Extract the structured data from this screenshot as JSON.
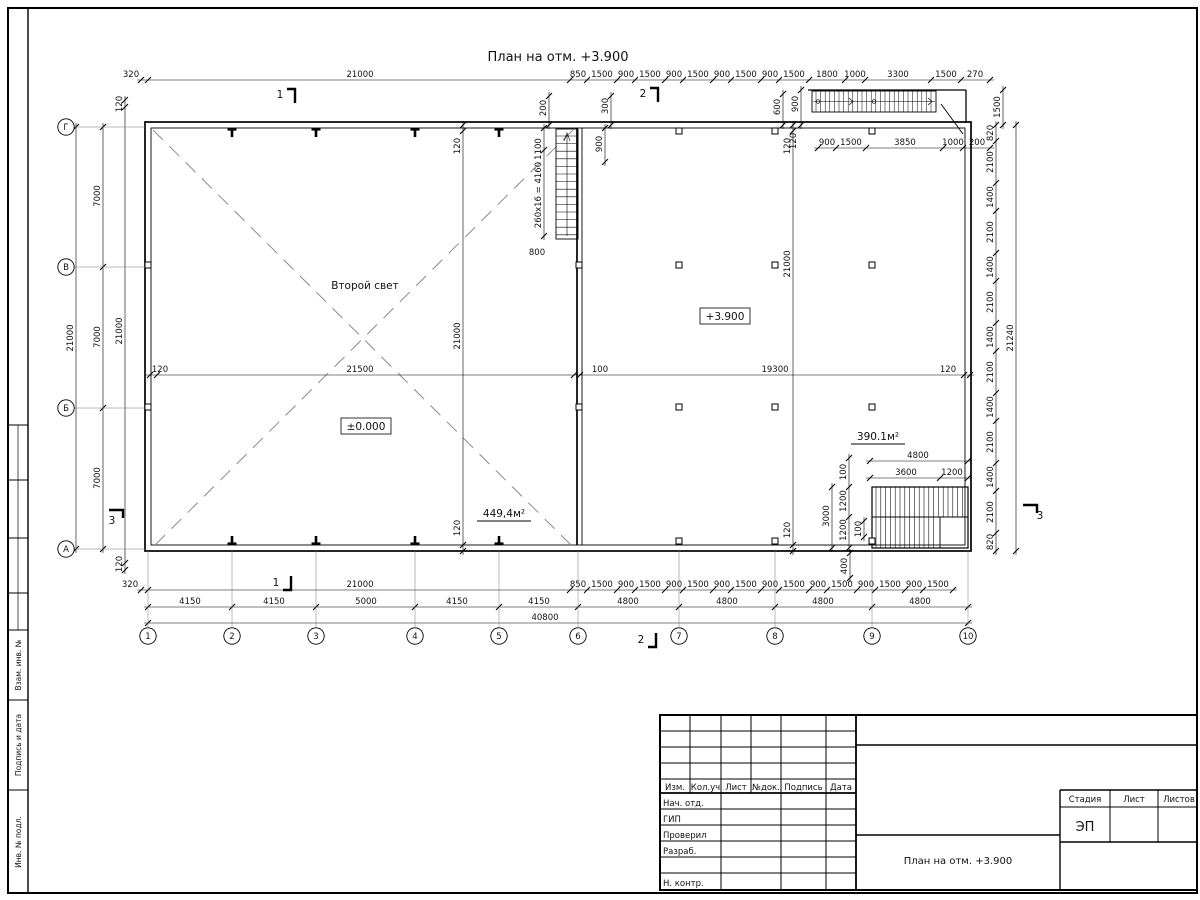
{
  "page": {
    "title": "План на отм. +3.900"
  },
  "colors": {
    "line": "#000000",
    "dash": "#8a8a8a",
    "bg": "#ffffff"
  },
  "rooms": [
    {
      "t": "Второй свет",
      "x": 365,
      "y": 289,
      "style": "plain"
    },
    {
      "t": "±0.000",
      "x": 366,
      "y": 430,
      "style": "boxed"
    },
    {
      "t": "+3.900",
      "x": 725,
      "y": 320,
      "style": "boxed"
    },
    {
      "t": "449,4м²",
      "x": 504,
      "y": 517,
      "style": "area"
    },
    {
      "t": "390.1м²",
      "x": 878,
      "y": 440,
      "style": "area"
    }
  ],
  "axes": {
    "letters": [
      {
        "t": "Г",
        "y": 127
      },
      {
        "t": "В",
        "y": 267
      },
      {
        "t": "Б",
        "y": 408
      },
      {
        "t": "А",
        "y": 549
      }
    ],
    "numbers": [
      {
        "t": "1",
        "x": 148
      },
      {
        "t": "2",
        "x": 232
      },
      {
        "t": "3",
        "x": 316
      },
      {
        "t": "4",
        "x": 415
      },
      {
        "t": "5",
        "x": 499
      },
      {
        "t": "6",
        "x": 578
      },
      {
        "t": "7",
        "x": 679
      },
      {
        "t": "8",
        "x": 775
      },
      {
        "t": "9",
        "x": 872
      },
      {
        "t": "10",
        "x": 968
      }
    ]
  },
  "markers": [
    {
      "t": "1",
      "x": 280,
      "y": 98,
      "d": "t"
    },
    {
      "t": "1",
      "x": 276,
      "y": 586,
      "d": "b"
    },
    {
      "t": "2",
      "x": 643,
      "y": 97,
      "d": "t"
    },
    {
      "t": "2",
      "x": 641,
      "y": 643,
      "d": "b"
    },
    {
      "t": "3",
      "x": 112,
      "y": 524,
      "d": "l"
    },
    {
      "t": "3",
      "x": 1040,
      "y": 519,
      "d": "r"
    }
  ],
  "dims": {
    "top_main": [
      {
        "t": "320",
        "p": 131
      },
      {
        "t": "21000",
        "p": 360
      },
      {
        "t": "850",
        "p": 578
      },
      {
        "t": "1500",
        "p": 602
      },
      {
        "t": "900",
        "p": 626
      },
      {
        "t": "1500",
        "p": 650
      },
      {
        "t": "900",
        "p": 674
      },
      {
        "t": "1500",
        "p": 698
      },
      {
        "t": "900",
        "p": 722
      },
      {
        "t": "1500",
        "p": 746
      },
      {
        "t": "900",
        "p": 770
      },
      {
        "t": "1500",
        "p": 794
      },
      {
        "t": "1800",
        "p": 827
      },
      {
        "t": "1000",
        "p": 855
      },
      {
        "t": "3300",
        "p": 898
      },
      {
        "t": "1500",
        "p": 946
      },
      {
        "t": "270",
        "p": 975
      }
    ],
    "top_sub": [
      {
        "t": "900",
        "p": 827
      },
      {
        "t": "1500",
        "p": 851
      },
      {
        "t": "3850",
        "p": 905
      },
      {
        "t": "1000",
        "p": 953
      },
      {
        "t": "200",
        "p": 977
      }
    ],
    "mid": [
      {
        "t": "120",
        "p": 160
      },
      {
        "t": "21500",
        "p": 360
      },
      {
        "t": "100",
        "p": 600
      },
      {
        "t": "19300",
        "p": 775
      },
      {
        "t": "120",
        "p": 948
      }
    ],
    "bot1": [
      {
        "t": "320",
        "p": 130
      },
      {
        "t": "21000",
        "p": 360
      },
      {
        "t": "850",
        "p": 578
      },
      {
        "t": "1500",
        "p": 602
      },
      {
        "t": "900",
        "p": 626
      },
      {
        "t": "1500",
        "p": 650
      },
      {
        "t": "900",
        "p": 674
      },
      {
        "t": "1500",
        "p": 698
      },
      {
        "t": "900",
        "p": 722
      },
      {
        "t": "1500",
        "p": 746
      },
      {
        "t": "900",
        "p": 770
      },
      {
        "t": "1500",
        "p": 794
      },
      {
        "t": "900",
        "p": 818
      },
      {
        "t": "1500",
        "p": 842
      },
      {
        "t": "900",
        "p": 866
      },
      {
        "t": "1500",
        "p": 890
      },
      {
        "t": "900",
        "p": 914
      },
      {
        "t": "1500",
        "p": 938
      }
    ],
    "bot2": [
      {
        "t": "4150",
        "p": 190
      },
      {
        "t": "4150",
        "p": 274
      },
      {
        "t": "5000",
        "p": 366
      },
      {
        "t": "4150",
        "p": 457
      },
      {
        "t": "4150",
        "p": 539
      },
      {
        "t": "4800",
        "p": 628
      },
      {
        "t": "4800",
        "p": 727
      },
      {
        "t": "4800",
        "p": 823
      },
      {
        "t": "4800",
        "p": 920
      }
    ],
    "bot3": [
      {
        "t": "40800",
        "p": 545
      }
    ],
    "br1": [
      {
        "t": "4800",
        "p": 918
      }
    ],
    "br2": [
      {
        "t": "3600",
        "p": 906
      },
      {
        "t": "1200",
        "p": 952
      }
    ],
    "left1": [
      {
        "t": "21000",
        "p": 338
      }
    ],
    "left2": [
      {
        "t": "7000",
        "p": 196
      },
      {
        "t": "7000",
        "p": 337
      },
      {
        "t": "7000",
        "p": 478
      }
    ],
    "left3": [
      {
        "t": "120",
        "p": 104
      },
      {
        "t": "21000",
        "p": 331
      },
      {
        "t": "120",
        "p": 564
      }
    ],
    "right1": [
      {
        "t": "820",
        "p": 133
      },
      {
        "t": "2100",
        "p": 162
      },
      {
        "t": "1400",
        "p": 197
      },
      {
        "t": "2100",
        "p": 232
      },
      {
        "t": "1400",
        "p": 267
      },
      {
        "t": "2100",
        "p": 302
      },
      {
        "t": "1400",
        "p": 337
      },
      {
        "t": "2100",
        "p": 372
      },
      {
        "t": "1400",
        "p": 407
      },
      {
        "t": "2100",
        "p": 442
      },
      {
        "t": "1400",
        "p": 477
      },
      {
        "t": "2100",
        "p": 512
      },
      {
        "t": "820",
        "p": 542
      }
    ],
    "right2": [
      {
        "t": "21240",
        "p": 338
      }
    ],
    "int460": [
      {
        "t": "120",
        "p": 146
      },
      {
        "t": "21000",
        "p": 336
      },
      {
        "t": "120",
        "p": 528
      }
    ],
    "int790": [
      {
        "t": "120",
        "p": 146
      },
      {
        "t": "21000",
        "p": 264
      },
      {
        "t": "120",
        "p": 530
      }
    ],
    "stair1": [
      {
        "t": "1100",
        "p": 149
      },
      {
        "t": "260x16 = 4160",
        "p": 195
      }
    ],
    "tv200": [
      {
        "t": "200",
        "p": 108
      }
    ],
    "tv300": [
      {
        "t": "300",
        "p": 106
      }
    ],
    "tv600": [
      {
        "t": "600",
        "p": 107
      }
    ],
    "tv900": [
      {
        "t": "900",
        "p": 104
      }
    ],
    "tv1500": [
      {
        "t": "1500",
        "p": 107
      }
    ],
    "op900": [
      {
        "t": "900",
        "p": 144
      }
    ],
    "brv1": [
      {
        "t": "3000",
        "p": 516
      }
    ],
    "brv2": [
      {
        "t": "100",
        "p": 472
      },
      {
        "t": "1200",
        "p": 501
      },
      {
        "t": "1200",
        "p": 530
      }
    ],
    "brv3": [
      {
        "t": "100",
        "p": 529
      }
    ],
    "brv4": [
      {
        "t": "400",
        "p": 566
      }
    ]
  },
  "stray_labels": [
    {
      "t": "120",
      "x": 796,
      "y": 141,
      "r": 1
    },
    {
      "t": "800",
      "x": 537,
      "y": 255,
      "r": 0
    }
  ],
  "titleblock": {
    "header": [
      "Изм.",
      "Кол.уч",
      "Лист",
      "№док.",
      "Подпись",
      "Дата"
    ],
    "rows": [
      "Нач. отд.",
      "ГИП",
      "Проверил",
      "Разраб.",
      "Н. контр."
    ],
    "doc_title": "План на отм. +3.900",
    "stage": {
      "labels": [
        "Стадия",
        "Лист",
        "Листов"
      ],
      "value": "ЭП"
    }
  },
  "side_strip": {
    "labels": [
      "Взам. инв. №",
      "Подпись и дата",
      "Инв. № подл."
    ]
  }
}
